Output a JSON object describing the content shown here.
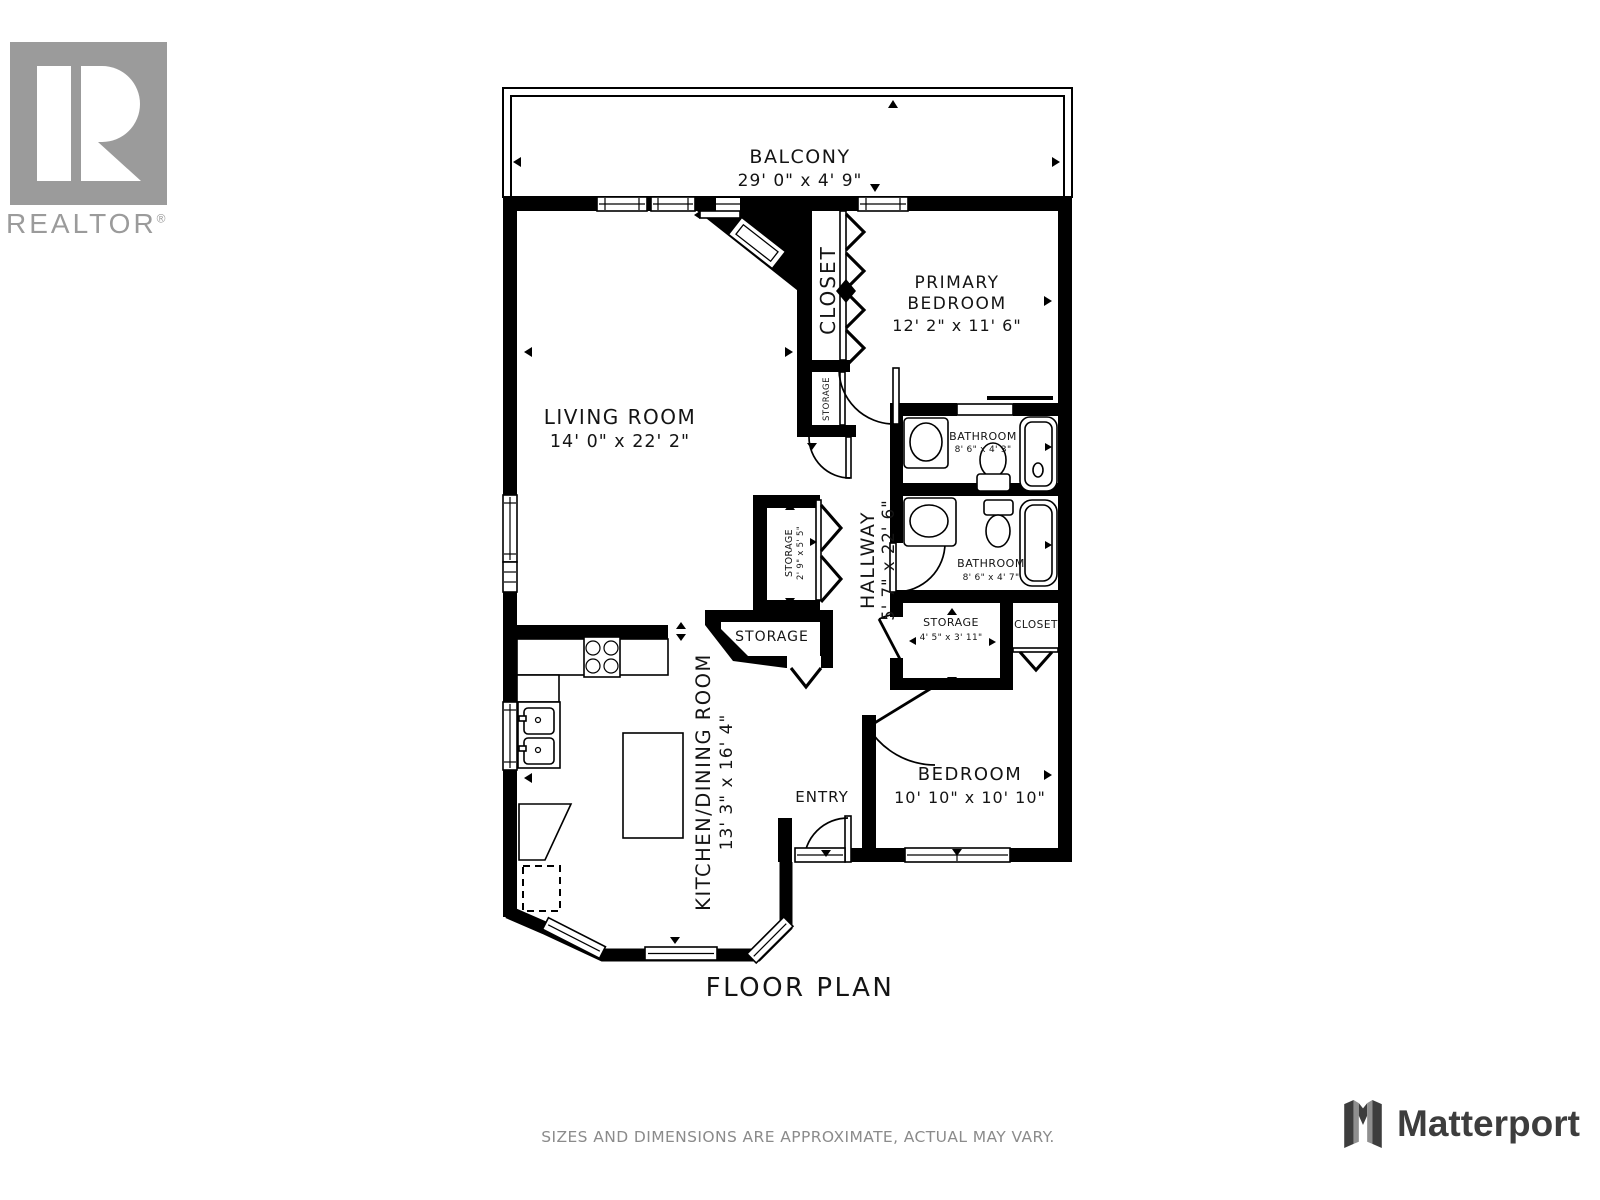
{
  "branding": {
    "realtor": {
      "label": "REALTOR",
      "reg": "®"
    },
    "matterport": {
      "label": "Matterport"
    }
  },
  "plan": {
    "title": "FLOOR PLAN",
    "disclaimer": "SIZES AND DIMENSIONS ARE APPROXIMATE, ACTUAL MAY VARY."
  },
  "rooms": {
    "balcony": {
      "name": "BALCONY",
      "dims": "29' 0\" x 4' 9\""
    },
    "living_room": {
      "name": "LIVING ROOM",
      "dims": "14' 0\" x 22' 2\""
    },
    "primary_bedroom": {
      "name_line1": "PRIMARY",
      "name_line2": "BEDROOM",
      "dims": "12' 2\" x 11' 6\""
    },
    "primary_closet": {
      "name": "CLOSET"
    },
    "closet_storage": {
      "name": "STORAGE"
    },
    "bathroom_top": {
      "name": "BATHROOM",
      "dims": "8' 6\" x 4' 3\""
    },
    "bathroom_bottom": {
      "name": "BATHROOM",
      "dims": "8' 6\" x 4' 7\""
    },
    "hallway": {
      "name": "HALLWAY",
      "dims": "5' 7\" x 22' 6\""
    },
    "hall_storage": {
      "name": "STORAGE",
      "dims": "2' 9\" x 5' 5\""
    },
    "entry_storage": {
      "name": "STORAGE"
    },
    "bedroom_storage": {
      "name": "STORAGE",
      "dims": "4' 5\" x 3' 11\""
    },
    "bedroom_closet": {
      "name": "CLOSET"
    },
    "kitchen_dining": {
      "name": "KITCHEN/DINING ROOM",
      "dims": "13' 3\" x 16' 4\""
    },
    "entry": {
      "name": "ENTRY"
    },
    "bedroom": {
      "name": "BEDROOM",
      "dims": "10' 10\" x 10' 10\""
    }
  },
  "colors": {
    "walls": "#000000",
    "labels": "#141414",
    "logo_gray": "#9b9b9b",
    "disclaimer_gray": "#8b8b8b",
    "matterport_dark": "#3d3d3d"
  }
}
